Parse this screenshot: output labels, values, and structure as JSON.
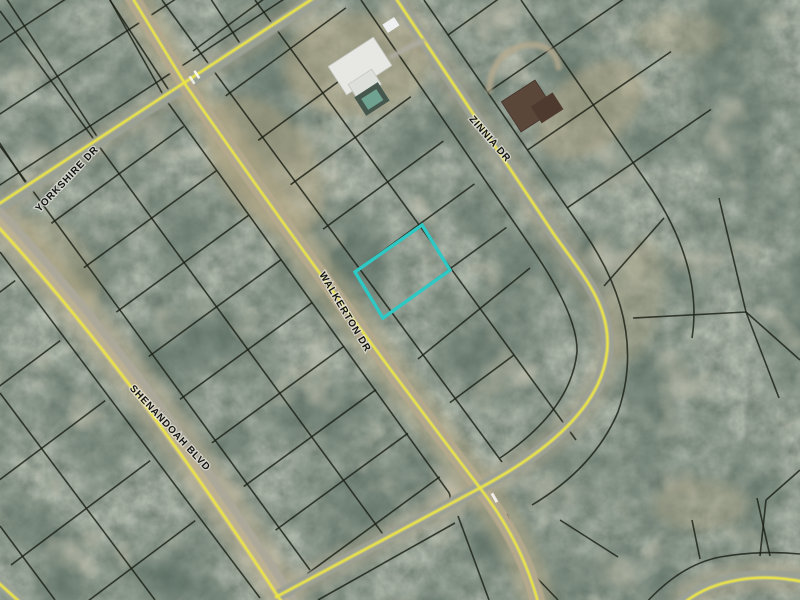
{
  "streets": [
    {
      "id": "yorkshire",
      "label": "YORKSHIRE DR"
    },
    {
      "id": "walkerton",
      "label": "WALKERTON DR"
    },
    {
      "id": "shenandoah",
      "label": "SHENANDOAH BLVD"
    },
    {
      "id": "zinnia",
      "label": "ZINNIA DR"
    }
  ],
  "highlighted_parcel": {
    "status": "selected",
    "outline_color": "#2FC9C5"
  },
  "colors": {
    "highlight_parcel": "#2FC9C5",
    "road_centerline": "#EFE83A",
    "parcel_line": "#1b2015",
    "label_text": "#131313",
    "label_halo": "#f2f2ec",
    "forest_base": "#41503F",
    "clearing_tan": "#B5A885",
    "road_pavement": "#9BA096"
  }
}
